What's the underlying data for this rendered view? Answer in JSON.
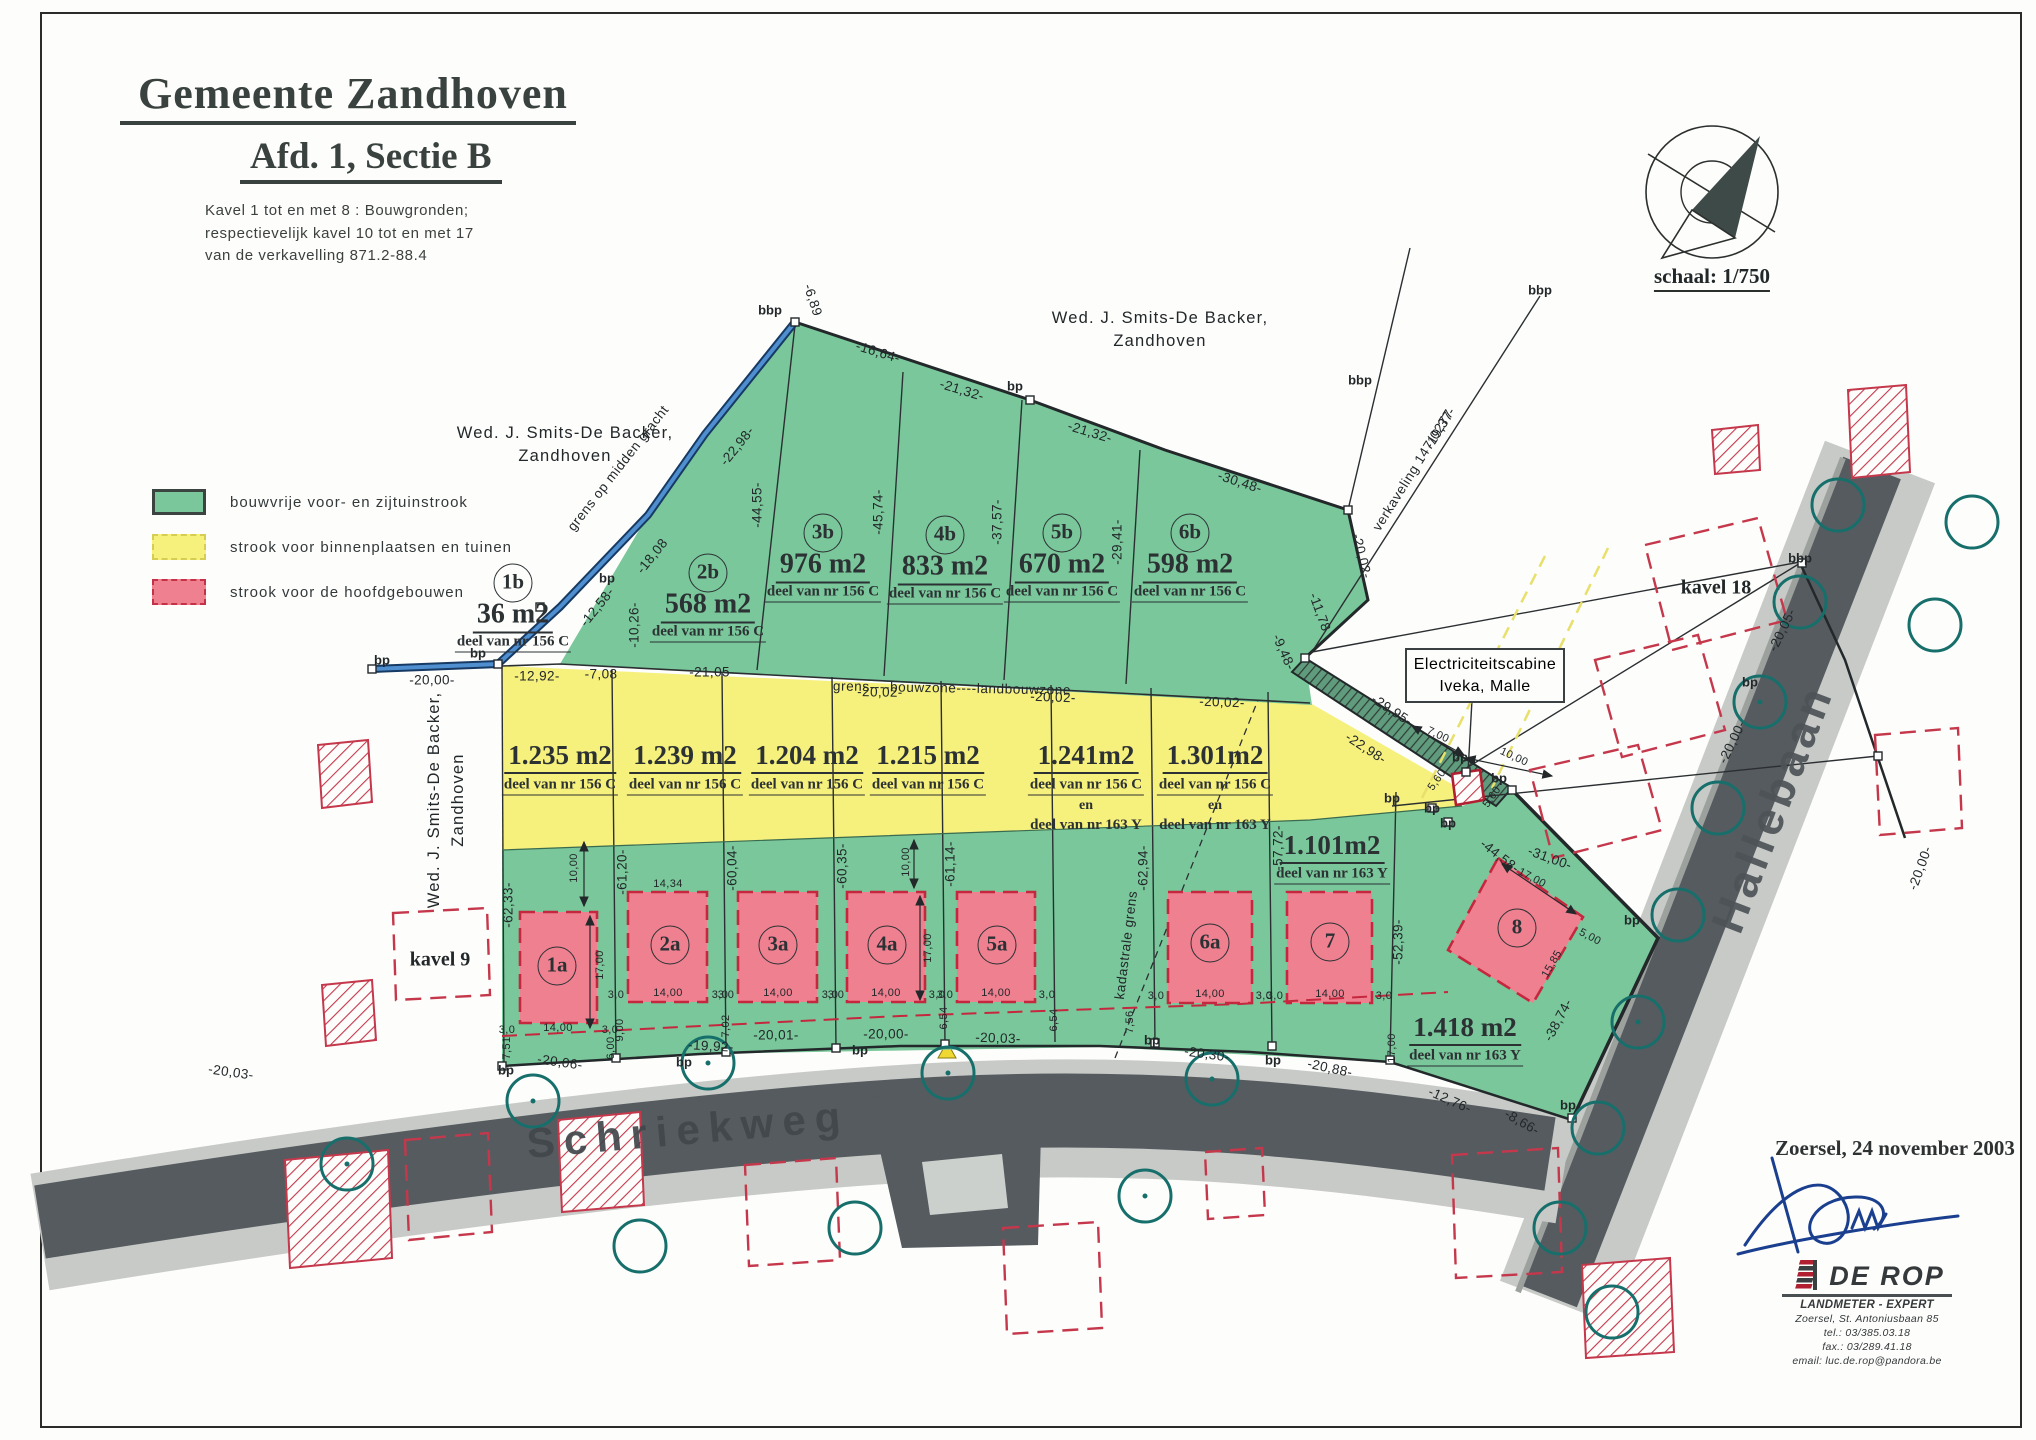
{
  "title": {
    "municipality": "Gemeente Zandhoven",
    "section": "Afd. 1, Sectie B",
    "note1": "Kavel 1 tot en met 8 : Bouwgronden;",
    "note2": "respectievelijk kavel 10 tot en met 17",
    "note3": "van de verkavelling 871.2-88.4"
  },
  "legend": {
    "items": [
      {
        "label": "bouwvrije voor- en zijtuinstrook",
        "color": "#79c79a"
      },
      {
        "label": "strook voor binnenplaatsen en tuinen",
        "color": "#f6f07c"
      },
      {
        "label": "strook voor de hoofdgebouwen",
        "color": "#ef8090"
      }
    ]
  },
  "compass": {
    "scale_label": "schaal: 1/750"
  },
  "owners": {
    "top": [
      "Wed. J. Smits-De Backer,",
      "Zandhoven"
    ],
    "left": [
      "Wed. J. Smits-De Backer,",
      "Zandhoven"
    ],
    "west_vertical": [
      "Wed. J. Smits-De Backer,",
      "Zandhoven"
    ]
  },
  "streets": {
    "schriekweg": "Schriekweg",
    "hallebaan": "Hallebaan"
  },
  "context": {
    "kavel9": "kavel 9",
    "kavel18": "kavel 18",
    "cabine1": "Electriciteitscabine",
    "cabine2": "Iveka, Malle",
    "verkaveling": "verkaveling 147/0277",
    "grens_gracht": "grens op midden gracht",
    "grens_bouwzone": "grens----bouwzone----landbouwzone",
    "kadastrale_grens": "kadastrale grens"
  },
  "parcels": {
    "b_row": [
      {
        "id": "1b",
        "area": "36 m2",
        "ref": "deel van nr 156 C"
      },
      {
        "id": "2b",
        "area": "568 m2",
        "ref": "deel van nr 156 C"
      },
      {
        "id": "3b",
        "area": "976 m2",
        "ref": "deel van nr 156 C"
      },
      {
        "id": "4b",
        "area": "833 m2",
        "ref": "deel van nr 156 C"
      },
      {
        "id": "5b",
        "area": "670 m2",
        "ref": "deel van nr 156 C"
      },
      {
        "id": "6b",
        "area": "598 m2",
        "ref": "deel van nr 156 C"
      }
    ],
    "mid_row": [
      {
        "area": "1.235 m2",
        "refs": [
          "deel van nr 156 C"
        ]
      },
      {
        "area": "1.239 m2",
        "refs": [
          "deel van nr 156 C"
        ]
      },
      {
        "area": "1.204 m2",
        "refs": [
          "deel van nr 156 C"
        ]
      },
      {
        "area": "1.215 m2",
        "refs": [
          "deel van nr 156 C"
        ]
      },
      {
        "area": "1.241m2",
        "refs": [
          "deel van nr 156 C",
          "en",
          "deel van nr 163 Y"
        ]
      },
      {
        "area": "1.301m2",
        "refs": [
          "deel van nr 156 C",
          "en",
          "deel van nr 163 Y"
        ]
      }
    ],
    "a_row": [
      "1a",
      "2a",
      "3a",
      "4a",
      "5a",
      "6a",
      "7",
      "8"
    ],
    "green_row": [
      {
        "area": "1.101m2",
        "ref": "deel van nr 163 Y"
      },
      {
        "area": "1.418 m2",
        "ref": "deel van nr 163 Y"
      }
    ]
  },
  "footer": {
    "date": "Zoersel, 24 november 2003",
    "firm": "DE ROP",
    "subtitle": "LANDMETER - EXPERT",
    "address": "Zoersel, St. Antoniusbaan 85",
    "tel": "tel.: 03/385.03.18",
    "fax": "fax.: 03/289.41.18",
    "email": "email: luc.de.rop@pandora.be"
  },
  "dimension_labels": [
    {
      "t": "-6,89",
      "x": 813,
      "y": 300,
      "r": 72
    },
    {
      "t": "-16,64-",
      "x": 878,
      "y": 352,
      "r": 17
    },
    {
      "t": "-21,32-",
      "x": 962,
      "y": 390,
      "r": 17
    },
    {
      "t": "-21,32-",
      "x": 1090,
      "y": 432,
      "r": 17
    },
    {
      "t": "-30,48-",
      "x": 1240,
      "y": 482,
      "r": 18
    },
    {
      "t": "-20,02-",
      "x": 1362,
      "y": 556,
      "r": 76
    },
    {
      "t": "-11,78",
      "x": 1320,
      "y": 612,
      "r": 70
    },
    {
      "t": "-9,48-",
      "x": 1284,
      "y": 652,
      "r": 66
    },
    {
      "t": "-19,37-",
      "x": 1440,
      "y": 428,
      "r": -58
    },
    {
      "t": "-22,98-",
      "x": 737,
      "y": 446,
      "r": -51
    },
    {
      "t": "-18,08",
      "x": 652,
      "y": 556,
      "r": -51
    },
    {
      "t": "-12,58-",
      "x": 597,
      "y": 607,
      "r": -51
    },
    {
      "t": "-10,26-",
      "x": 634,
      "y": 625,
      "r": -90
    },
    {
      "t": "-20,00-",
      "x": 432,
      "y": 680,
      "r": 0
    },
    {
      "t": "-12,92-",
      "x": 537,
      "y": 676,
      "r": 0
    },
    {
      "t": "-7,08",
      "x": 601,
      "y": 674,
      "r": 0
    },
    {
      "t": "-21,05-",
      "x": 712,
      "y": 672,
      "r": 0
    },
    {
      "t": "-20,02-",
      "x": 880,
      "y": 692,
      "r": 1
    },
    {
      "t": "-20,02-",
      "x": 1053,
      "y": 697,
      "r": 2
    },
    {
      "t": "-20,02-",
      "x": 1222,
      "y": 702,
      "r": 2
    },
    {
      "t": "-44,55-",
      "x": 757,
      "y": 505,
      "r": -90
    },
    {
      "t": "-45,74-",
      "x": 878,
      "y": 512,
      "r": -90
    },
    {
      "t": "-37,57-",
      "x": 997,
      "y": 522,
      "r": -90
    },
    {
      "t": "-29,41-",
      "x": 1117,
      "y": 542,
      "r": -90
    },
    {
      "t": "-62,33-",
      "x": 508,
      "y": 905,
      "r": -90
    },
    {
      "t": "-61,20-",
      "x": 622,
      "y": 872,
      "r": -90
    },
    {
      "t": "-60,04-",
      "x": 732,
      "y": 868,
      "r": -90
    },
    {
      "t": "-60,35-",
      "x": 842,
      "y": 866,
      "r": -90
    },
    {
      "t": "-61,14-",
      "x": 950,
      "y": 864,
      "r": -90
    },
    {
      "t": "-62,94-",
      "x": 1143,
      "y": 868,
      "r": -90
    },
    {
      "t": "-57,72-",
      "x": 1278,
      "y": 848,
      "r": -90
    },
    {
      "t": "-52,39-",
      "x": 1398,
      "y": 942,
      "r": -90
    },
    {
      "t": "-20,03-",
      "x": 231,
      "y": 1072,
      "r": 8
    },
    {
      "t": "-20,06-",
      "x": 560,
      "y": 1062,
      "r": 8
    },
    {
      "t": "-19,92-",
      "x": 711,
      "y": 1046,
      "r": 3
    },
    {
      "t": "-20,01-",
      "x": 776,
      "y": 1035,
      "r": 0
    },
    {
      "t": "-20,00-",
      "x": 886,
      "y": 1034,
      "r": 0
    },
    {
      "t": "-20,03-",
      "x": 998,
      "y": 1038,
      "r": 2
    },
    {
      "t": "-20,30-",
      "x": 1207,
      "y": 1054,
      "r": 8
    },
    {
      "t": "-20,88-",
      "x": 1330,
      "y": 1068,
      "r": 12
    },
    {
      "t": "-12,76-",
      "x": 1450,
      "y": 1100,
      "r": 24
    },
    {
      "t": "-8,66-",
      "x": 1522,
      "y": 1122,
      "r": 30
    },
    {
      "t": "-29,95-",
      "x": 1392,
      "y": 710,
      "r": 33
    },
    {
      "t": "-22,98-",
      "x": 1366,
      "y": 748,
      "r": 33
    },
    {
      "t": "-44,58-",
      "x": 1500,
      "y": 856,
      "r": 38
    },
    {
      "t": "-31,00-",
      "x": 1550,
      "y": 858,
      "r": 20
    },
    {
      "t": "-38,74-",
      "x": 1558,
      "y": 1020,
      "r": -62
    },
    {
      "t": "-20,05-",
      "x": 1782,
      "y": 630,
      "r": -64
    },
    {
      "t": "-20,00-",
      "x": 1732,
      "y": 742,
      "r": -64
    },
    {
      "t": "-20,00-",
      "x": 1920,
      "y": 868,
      "r": -70
    },
    {
      "t": "17,00",
      "x": 1532,
      "y": 878,
      "r": 28,
      "s": 1
    },
    {
      "t": "5,00",
      "x": 1590,
      "y": 937,
      "r": 28,
      "s": 1
    },
    {
      "t": "15,85",
      "x": 1552,
      "y": 964,
      "r": -60,
      "s": 1
    },
    {
      "t": "7,00",
      "x": 1438,
      "y": 735,
      "r": 25,
      "s": 1
    },
    {
      "t": "10,00",
      "x": 1514,
      "y": 757,
      "r": 25,
      "s": 1
    },
    {
      "t": "5,60",
      "x": 1437,
      "y": 780,
      "r": -55,
      "s": 1
    },
    {
      "t": "5,60",
      "x": 1492,
      "y": 797,
      "r": -55,
      "s": 1
    },
    {
      "t": "14,34",
      "x": 668,
      "y": 884,
      "r": 0,
      "s": 1
    },
    {
      "t": "10,00",
      "x": 574,
      "y": 868,
      "r": -90,
      "s": 1
    },
    {
      "t": "17,00",
      "x": 600,
      "y": 965,
      "r": -90,
      "s": 1
    },
    {
      "t": "10,00",
      "x": 906,
      "y": 862,
      "r": -90,
      "s": 1
    },
    {
      "t": "17,00",
      "x": 928,
      "y": 948,
      "r": -90,
      "s": 1
    },
    {
      "t": "3,0",
      "x": 507,
      "y": 1030,
      "r": 0,
      "s": 1
    },
    {
      "t": "14,00",
      "x": 558,
      "y": 1028,
      "r": 0,
      "s": 1
    },
    {
      "t": "3,0",
      "x": 610,
      "y": 1030,
      "r": 0,
      "s": 1
    },
    {
      "t": "3,0",
      "x": 616,
      "y": 995,
      "r": 0,
      "s": 1
    },
    {
      "t": "14,00",
      "x": 668,
      "y": 993,
      "r": 0,
      "s": 1
    },
    {
      "t": "3,0",
      "x": 720,
      "y": 995,
      "r": 0,
      "s": 1
    },
    {
      "t": "3,0",
      "x": 726,
      "y": 995,
      "r": 0,
      "s": 1
    },
    {
      "t": "14,00",
      "x": 778,
      "y": 993,
      "r": 0,
      "s": 1
    },
    {
      "t": "3,0",
      "x": 830,
      "y": 995,
      "r": 0,
      "s": 1
    },
    {
      "t": "3,0",
      "x": 836,
      "y": 995,
      "r": 0,
      "s": 1
    },
    {
      "t": "14,00",
      "x": 886,
      "y": 993,
      "r": 0,
      "s": 1
    },
    {
      "t": "3,0",
      "x": 937,
      "y": 995,
      "r": 0,
      "s": 1
    },
    {
      "t": "3,0",
      "x": 945,
      "y": 995,
      "r": 0,
      "s": 1
    },
    {
      "t": "14,00",
      "x": 996,
      "y": 993,
      "r": 0,
      "s": 1
    },
    {
      "t": "3,0",
      "x": 1047,
      "y": 995,
      "r": 0,
      "s": 1
    },
    {
      "t": "3,0",
      "x": 1156,
      "y": 996,
      "r": 0,
      "s": 1
    },
    {
      "t": "14,00",
      "x": 1210,
      "y": 994,
      "r": 0,
      "s": 1
    },
    {
      "t": "3,0",
      "x": 1264,
      "y": 996,
      "r": 0,
      "s": 1
    },
    {
      "t": "3,0",
      "x": 1275,
      "y": 996,
      "r": 0,
      "s": 1
    },
    {
      "t": "14,00",
      "x": 1330,
      "y": 994,
      "r": 0,
      "s": 1
    },
    {
      "t": "3,0",
      "x": 1384,
      "y": 996,
      "r": 0,
      "s": 1
    },
    {
      "t": "7,51",
      "x": 507,
      "y": 1048,
      "r": -90,
      "s": 1
    },
    {
      "t": "9,00",
      "x": 620,
      "y": 1030,
      "r": -90,
      "s": 1
    },
    {
      "t": "6,00",
      "x": 611,
      "y": 1048,
      "r": -90,
      "s": 1
    },
    {
      "t": "7,02",
      "x": 726,
      "y": 1026,
      "r": -90,
      "s": 1
    },
    {
      "t": "6,54",
      "x": 944,
      "y": 1018,
      "r": -90,
      "s": 1
    },
    {
      "t": "6,54",
      "x": 1054,
      "y": 1020,
      "r": -90,
      "s": 1
    },
    {
      "t": "7,56",
      "x": 1130,
      "y": 1022,
      "r": -90,
      "s": 1
    },
    {
      "t": "17,00",
      "x": 1392,
      "y": 1048,
      "r": -90,
      "s": 1
    }
  ],
  "point_labels": [
    {
      "t": "bbp",
      "x": 770,
      "y": 310
    },
    {
      "t": "bp",
      "x": 1015,
      "y": 386
    },
    {
      "t": "bp",
      "x": 607,
      "y": 578
    },
    {
      "t": "bp",
      "x": 478,
      "y": 653
    },
    {
      "t": "bp",
      "x": 382,
      "y": 660
    },
    {
      "t": "bbp",
      "x": 1540,
      "y": 290
    },
    {
      "t": "bbp",
      "x": 1360,
      "y": 380
    },
    {
      "t": "bbp",
      "x": 1800,
      "y": 558
    },
    {
      "t": "bp",
      "x": 1750,
      "y": 682
    },
    {
      "t": "bp",
      "x": 506,
      "y": 1070
    },
    {
      "t": "bp",
      "x": 684,
      "y": 1062
    },
    {
      "t": "bp",
      "x": 860,
      "y": 1050
    },
    {
      "t": "bp",
      "x": 1152,
      "y": 1040
    },
    {
      "t": "bp",
      "x": 1273,
      "y": 1060
    },
    {
      "t": "bp",
      "x": 1448,
      "y": 823
    },
    {
      "t": "bp",
      "x": 1632,
      "y": 920
    },
    {
      "t": "bp",
      "x": 1568,
      "y": 1105
    },
    {
      "t": "bp",
      "x": 1460,
      "y": 757
    },
    {
      "t": "bp",
      "x": 1499,
      "y": 778
    },
    {
      "t": "bp",
      "x": 1432,
      "y": 808
    },
    {
      "t": "bp",
      "x": 1392,
      "y": 798
    }
  ]
}
